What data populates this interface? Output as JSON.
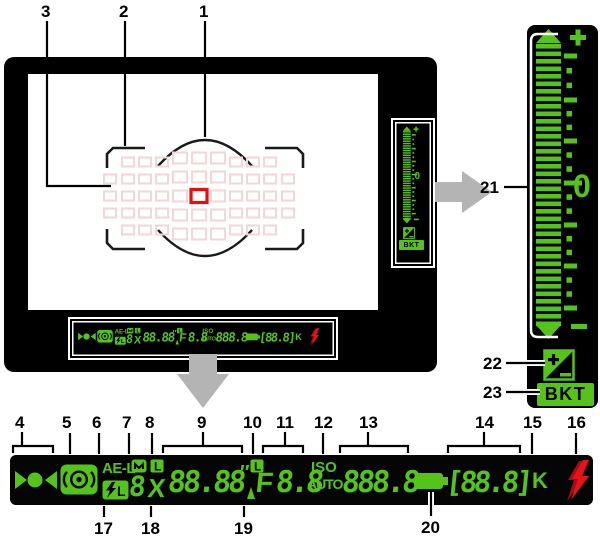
{
  "callouts": {
    "c1": "1",
    "c2": "2",
    "c3": "3",
    "c4": "4",
    "c5": "5",
    "c6": "6",
    "c7": "7",
    "c8": "8",
    "c9": "9",
    "c10": "10",
    "c11": "11",
    "c12": "12",
    "c13": "13",
    "c14": "14",
    "c15": "15",
    "c16": "16",
    "c17": "17",
    "c18": "18",
    "c19": "19",
    "c20": "20",
    "c21": "21",
    "c22": "22",
    "c23": "23"
  },
  "statusbar": {
    "ae_lock_label": "AE-L",
    "fv_lock_label": "L",
    "mode_digit": "8",
    "shutter_lock_label": "L",
    "flash_sync_label": "X",
    "shutter_speed_value": "88.88",
    "seconds_mark": "″",
    "aperture_lock_label": "L",
    "aperture_stop_label": "F",
    "aperture_value": "8.8",
    "iso_label": "ISO",
    "iso_auto_label": "AUTO",
    "iso_value": "888.8",
    "frames_remaining_value": "[88.8]",
    "thousands_label": "K",
    "icons": [
      "focus-indicator",
      "metering-icon",
      "fv-lock-bolt-icon",
      "battery-icon",
      "flash-ready-bolt-icon"
    ]
  },
  "exposure_scale": {
    "plus_label": "+",
    "zero_label": "0",
    "minus_label": "−",
    "bkt_label": "BKT",
    "full_stop_ticks": 7,
    "dots_between_stops": 2
  },
  "focus_grid": {
    "total_points": 51,
    "edge_col_x": [
      82,
      260
    ],
    "side_col_x": [
      100,
      117,
      134,
      208,
      225,
      242
    ],
    "mid_col_x": [
      152,
      171,
      190
    ],
    "side_row_y": [
      88,
      105,
      122,
      139,
      156
    ],
    "mid_row_y": [
      84,
      103,
      122,
      141,
      160
    ],
    "edge_row_y": [
      105,
      122,
      139
    ],
    "active_point": {
      "x": 171,
      "y": 122
    }
  },
  "colors": {
    "lcd_green": "#54c31a",
    "flash_red": "#e8121b",
    "flash_red_dark": "#9e0e13",
    "af_point_faint": "#f3d6d6",
    "af_point_active": "#ee0a0a",
    "arrow_gray": "#b4b4b4"
  }
}
